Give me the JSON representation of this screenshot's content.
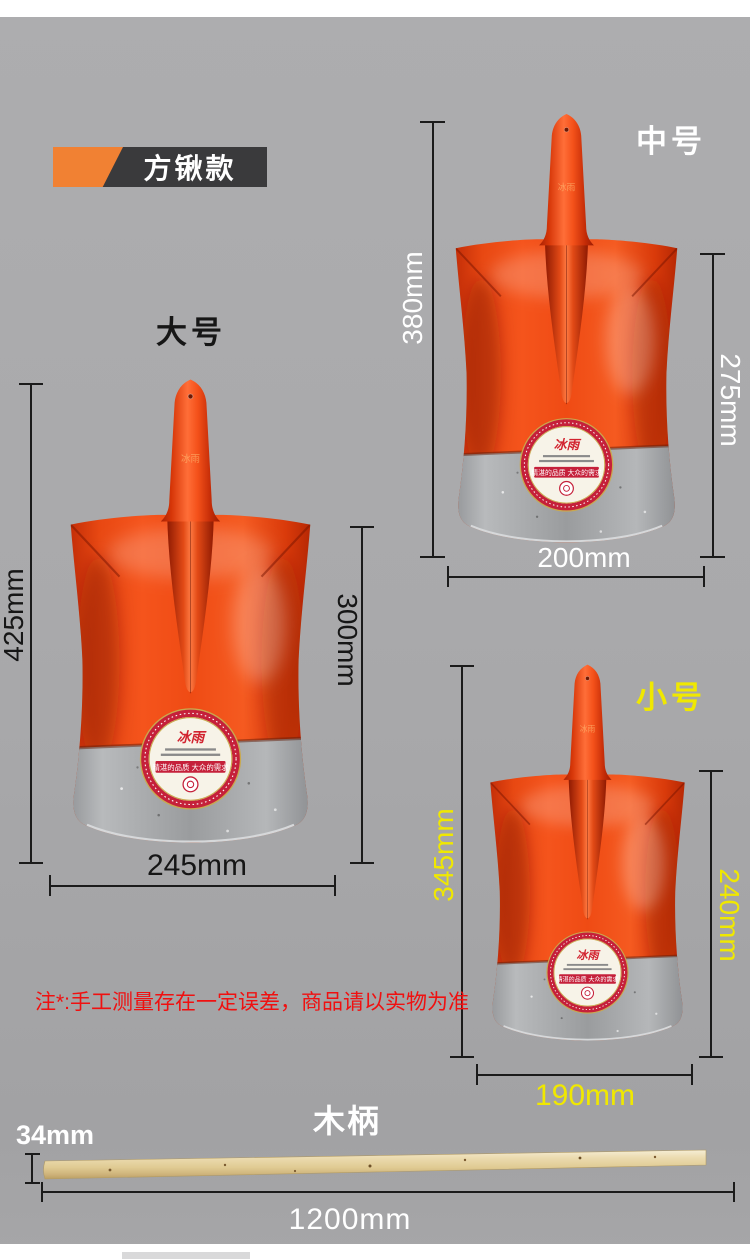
{
  "banner": {
    "label": "方锹款"
  },
  "sticker": {
    "brand": "冰雨",
    "slogan": "精湛的品质 大众的需求"
  },
  "shovels": [
    {
      "key": "large",
      "label": "大号",
      "total_height": "425mm",
      "blade_height": "300mm",
      "blade_width": "245mm",
      "text_color": "#161616"
    },
    {
      "key": "medium",
      "label": "中号",
      "total_height": "380mm",
      "blade_height": "275mm",
      "blade_width": "200mm",
      "text_color": "#ffffff"
    },
    {
      "key": "small",
      "label": "小号",
      "total_height": "345mm",
      "blade_height": "240mm",
      "blade_width": "190mm",
      "text_color": "#f0e800"
    }
  ],
  "note": {
    "text": "注*:手工测量存在一定误差，商品请以实物为准"
  },
  "handle": {
    "title": "木柄",
    "diameter": "34mm",
    "length": "1200mm"
  },
  "colors": {
    "background": "#a9a9ab",
    "banner_dark": "#3a3a3c",
    "accent_orange": "#f18133",
    "dimension_line": "#1b1b1b",
    "shovel_red": "#ef4b14",
    "steel_gray": "#9a9c9e",
    "wood": "#e6d4a8",
    "note_red": "#f01010",
    "yellow_text": "#f0e800"
  }
}
